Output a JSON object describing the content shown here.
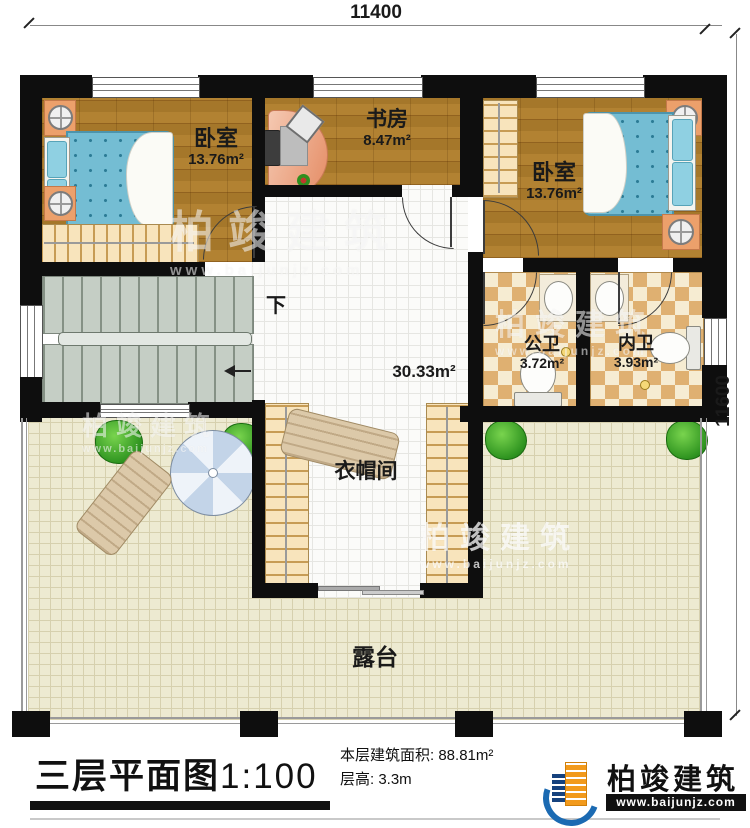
{
  "dimensions": {
    "width": "11400",
    "height": "11600"
  },
  "rooms": {
    "bedroom_left": {
      "name": "卧室",
      "area": "13.76m²"
    },
    "study": {
      "name": "书房",
      "area": "8.47m²"
    },
    "bedroom_right": {
      "name": "卧室",
      "area": "13.76m²"
    },
    "public_bath": {
      "name": "公卫",
      "area": "3.72m²"
    },
    "inner_bath": {
      "name": "内卫",
      "area": "3.93m²"
    },
    "hall": {
      "area": "30.33m²"
    },
    "cloakroom": {
      "name": "衣帽间"
    },
    "terrace": {
      "name": "露台"
    },
    "stairs": {
      "down_label": "下"
    }
  },
  "footer": {
    "title": "三层平面图",
    "scale": "1:100",
    "floor_area": "本层建筑面积: 88.81m²",
    "floor_height": "层高: 3.3m"
  },
  "brand": {
    "name": "柏竣建筑",
    "website": "www.baijunjz.com"
  },
  "watermark": {
    "name": "柏竣建筑",
    "website": "www.baijunjz.com"
  }
}
